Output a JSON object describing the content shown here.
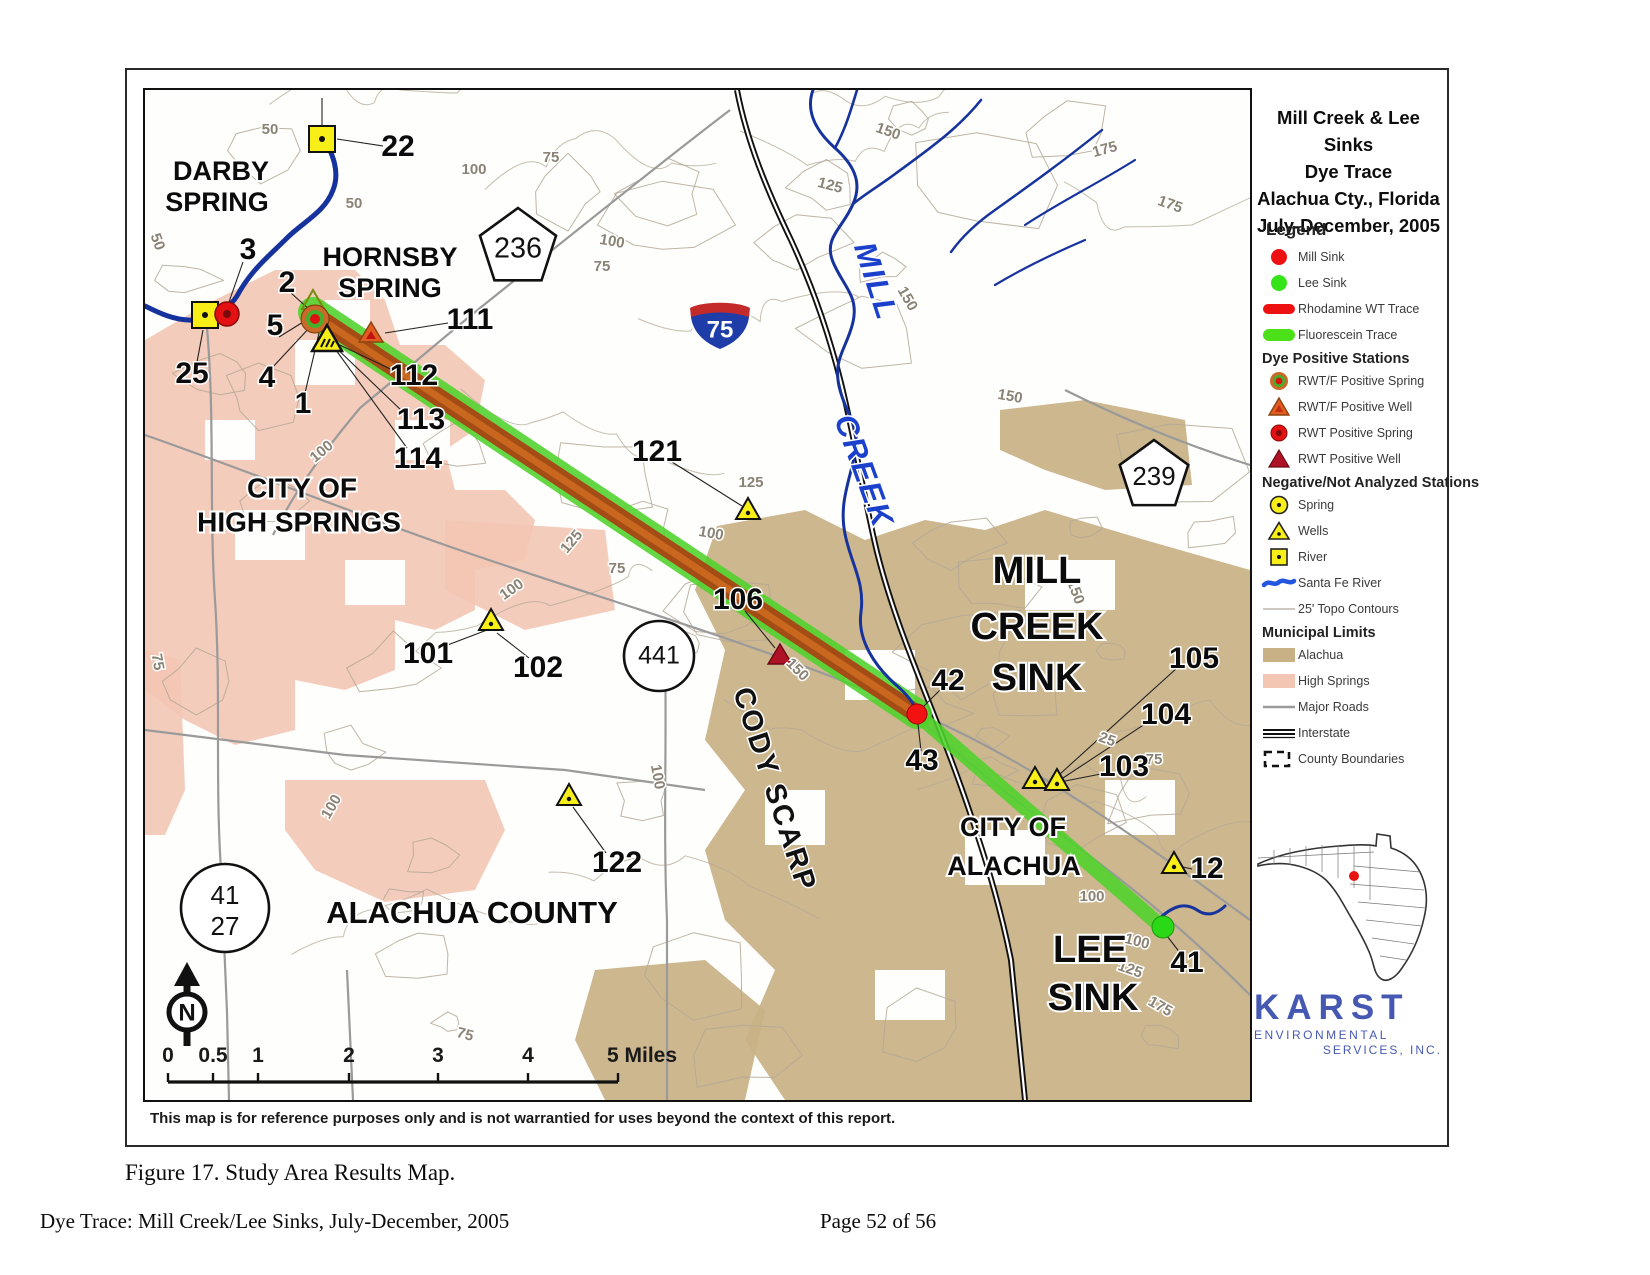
{
  "page": {
    "caption": "Figure 17.  Study Area Results Map.",
    "footer_left": "Dye Trace: Mill Creek/Lee Sinks, July-December, 2005",
    "footer_right": "Page 52 of 56",
    "disclaimer": "This map is for reference purposes only and is not warrantied for uses beyond the context of this report."
  },
  "title_block": {
    "lines": [
      "Mill Creek & Lee Sinks",
      "Dye Trace",
      "Alachua Cty., Florida",
      "July-December, 2005"
    ]
  },
  "legend": {
    "header": "Legend",
    "sections": [
      {
        "header": "",
        "items": [
          {
            "icon": "mill-sink",
            "label": "Mill Sink"
          },
          {
            "icon": "lee-sink",
            "label": "Lee Sink"
          },
          {
            "icon": "rhodamine-trace",
            "label": "Rhodamine WT Trace"
          },
          {
            "icon": "fluorescein-trace",
            "label": "Fluorescein Trace"
          }
        ]
      },
      {
        "header": "Dye Positive Stations",
        "items": [
          {
            "icon": "rwtf-spring",
            "label": "RWT/F Positive Spring"
          },
          {
            "icon": "rwtf-well",
            "label": "RWT/F Positive Well"
          },
          {
            "icon": "rwt-spring",
            "label": "RWT Positive Spring"
          },
          {
            "icon": "rwt-well",
            "label": "RWT Positive Well"
          }
        ]
      },
      {
        "header": "Negative/Not Analyzed Stations",
        "items": [
          {
            "icon": "neg-spring",
            "label": "Spring"
          },
          {
            "icon": "neg-well",
            "label": "Wells"
          },
          {
            "icon": "neg-river",
            "label": "River"
          },
          {
            "icon": "santa-fe",
            "label": "Santa Fe River"
          },
          {
            "icon": "contour",
            "label": "25' Topo Contours"
          }
        ]
      },
      {
        "header": "Municipal Limits",
        "items": [
          {
            "icon": "alachua-swatch",
            "label": "Alachua"
          },
          {
            "icon": "high-springs-swatch",
            "label": "High Springs"
          },
          {
            "icon": "major-road",
            "label": "Major Roads"
          },
          {
            "icon": "interstate",
            "label": "Interstate"
          },
          {
            "icon": "county-boundary",
            "label": "County Boundaries"
          }
        ]
      }
    ]
  },
  "logo": {
    "name": "KARST",
    "line1": "ENVIRONMENTAL",
    "line2": "SERVICES, INC."
  },
  "map": {
    "north_label": "N",
    "scale": {
      "labels": [
        {
          "t": "0",
          "x": 23
        },
        {
          "t": "0.5",
          "x": 68
        },
        {
          "t": "1",
          "x": 113
        },
        {
          "t": "2",
          "x": 204
        },
        {
          "t": "3",
          "x": 293
        },
        {
          "t": "4",
          "x": 383
        },
        {
          "t": "5 Miles",
          "x": 462,
          "start": true
        }
      ],
      "ticks": [
        23,
        68,
        113,
        204,
        293,
        383,
        473
      ],
      "x1": 23,
      "x2": 473,
      "y_bar": 992,
      "y_label": 972
    },
    "station_labels": [
      {
        "t": "22",
        "x": 253,
        "y": 58
      },
      {
        "t": "3",
        "x": 103,
        "y": 161
      },
      {
        "t": "2",
        "x": 142,
        "y": 194
      },
      {
        "t": "5",
        "x": 130,
        "y": 237
      },
      {
        "t": "25",
        "x": 47,
        "y": 285
      },
      {
        "t": "4",
        "x": 122,
        "y": 289
      },
      {
        "t": "1",
        "x": 158,
        "y": 315
      },
      {
        "t": "111",
        "x": 325,
        "y": 231
      },
      {
        "t": "112",
        "x": 269,
        "y": 287
      },
      {
        "t": "113",
        "x": 276,
        "y": 331
      },
      {
        "t": "114",
        "x": 273,
        "y": 370
      },
      {
        "t": "121",
        "x": 512,
        "y": 363
      },
      {
        "t": "101",
        "x": 283,
        "y": 565
      },
      {
        "t": "102",
        "x": 393,
        "y": 579
      },
      {
        "t": "106",
        "x": 593,
        "y": 511
      },
      {
        "t": "42",
        "x": 803,
        "y": 592
      },
      {
        "t": "43",
        "x": 777,
        "y": 672
      },
      {
        "t": "105",
        "x": 1049,
        "y": 570
      },
      {
        "t": "104",
        "x": 1021,
        "y": 626
      },
      {
        "t": "103",
        "x": 979,
        "y": 678
      },
      {
        "t": "122",
        "x": 472,
        "y": 774
      },
      {
        "t": "12",
        "x": 1062,
        "y": 780
      },
      {
        "t": "41",
        "x": 1042,
        "y": 874
      }
    ],
    "place_labels": [
      {
        "t": "DARBY",
        "x": 76,
        "y": 83,
        "s": 27
      },
      {
        "t": "SPRING",
        "x": 72,
        "y": 114,
        "s": 27
      },
      {
        "t": "HORNSBY",
        "x": 245,
        "y": 169,
        "s": 27
      },
      {
        "t": "SPRING",
        "x": 245,
        "y": 200,
        "s": 27
      },
      {
        "t": "CITY OF",
        "x": 157,
        "y": 400,
        "s": 28
      },
      {
        "t": "HIGH SPRINGS",
        "x": 154,
        "y": 434,
        "s": 28
      },
      {
        "t": "ALACHUA COUNTY",
        "x": 327,
        "y": 825,
        "s": 31
      },
      {
        "t": "MILL",
        "x": 892,
        "y": 483,
        "s": 38
      },
      {
        "t": "CREEK",
        "x": 892,
        "y": 539,
        "s": 38
      },
      {
        "t": "SINK",
        "x": 892,
        "y": 590,
        "s": 38
      },
      {
        "t": "CITY OF",
        "x": 868,
        "y": 739,
        "s": 27
      },
      {
        "t": "ALACHUA",
        "x": 869,
        "y": 778,
        "s": 27
      },
      {
        "t": "LEE",
        "x": 945,
        "y": 862,
        "s": 38
      },
      {
        "t": "SINK",
        "x": 948,
        "y": 910,
        "s": 38
      }
    ],
    "rotated_labels": [
      {
        "t": "CODY SCARP",
        "x": 628,
        "y": 700,
        "s": 29,
        "r": 72,
        "c": "#111"
      },
      {
        "t": "MILL",
        "x": 729,
        "y": 192,
        "s": 31,
        "r": 72,
        "c": "#1b41cc",
        "i": true
      },
      {
        "t": "CREEK",
        "x": 717,
        "y": 382,
        "s": 31,
        "r": 70,
        "c": "#1b41cc",
        "i": true
      }
    ],
    "contour_labels": [
      {
        "t": "50",
        "x": 125,
        "y": 40
      },
      {
        "t": "100",
        "x": 329,
        "y": 80
      },
      {
        "t": "75",
        "x": 406,
        "y": 68
      },
      {
        "t": "50",
        "x": 209,
        "y": 114
      },
      {
        "t": "150",
        "x": 743,
        "y": 42,
        "r": 20
      },
      {
        "t": "125",
        "x": 685,
        "y": 96,
        "r": 15
      },
      {
        "t": "175",
        "x": 960,
        "y": 60,
        "r": -15
      },
      {
        "t": "175",
        "x": 1025,
        "y": 115,
        "r": 20
      },
      {
        "t": "100",
        "x": 467,
        "y": 152,
        "r": 10
      },
      {
        "t": "75",
        "x": 457,
        "y": 177
      },
      {
        "t": "150",
        "x": 762,
        "y": 209,
        "r": 60
      },
      {
        "t": "150",
        "x": 865,
        "y": 307,
        "r": 10
      },
      {
        "t": "100",
        "x": 177,
        "y": 362,
        "r": -40
      },
      {
        "t": "125",
        "x": 427,
        "y": 452,
        "r": -50
      },
      {
        "t": "100",
        "x": 367,
        "y": 500,
        "r": -35
      },
      {
        "t": "75",
        "x": 472,
        "y": 479
      },
      {
        "t": "125",
        "x": 606,
        "y": 393
      },
      {
        "t": "100",
        "x": 566,
        "y": 444,
        "r": 10
      },
      {
        "t": "50",
        "x": 12,
        "y": 152,
        "r": 70
      },
      {
        "t": "75",
        "x": 12,
        "y": 572,
        "r": 80
      },
      {
        "t": "100",
        "x": 187,
        "y": 717,
        "r": -60
      },
      {
        "t": "100",
        "x": 512,
        "y": 687,
        "r": 80
      },
      {
        "t": "150",
        "x": 930,
        "y": 502,
        "r": 70
      },
      {
        "t": "25",
        "x": 962,
        "y": 650,
        "r": 20
      },
      {
        "t": "75",
        "x": 1009,
        "y": 670
      },
      {
        "t": "100",
        "x": 947,
        "y": 807
      },
      {
        "t": "100",
        "x": 992,
        "y": 852,
        "r": 15
      },
      {
        "t": "125",
        "x": 985,
        "y": 880,
        "r": 20
      },
      {
        "t": "175",
        "x": 1015,
        "y": 917,
        "r": 30
      },
      {
        "t": "75",
        "x": 320,
        "y": 945,
        "r": 15
      },
      {
        "t": "150",
        "x": 652,
        "y": 580,
        "r": 45
      }
    ],
    "shields": [
      {
        "kind": "pentagon",
        "label": "236",
        "x": 373,
        "y": 154,
        "r": 40
      },
      {
        "kind": "pentagon",
        "label": "239",
        "x": 1009,
        "y": 382,
        "r": 36
      },
      {
        "kind": "interstate",
        "label": "75",
        "x": 575,
        "y": 233
      },
      {
        "kind": "circle1",
        "label": "441",
        "x": 514,
        "y": 566,
        "r": 35
      },
      {
        "kind": "circle2",
        "top": "41",
        "bottom": "27",
        "x": 80,
        "y": 818,
        "r": 44
      }
    ],
    "markers": [
      {
        "type": "river",
        "x": 177,
        "y": 49
      },
      {
        "type": "river",
        "x": 60,
        "y": 225
      },
      {
        "type": "rwt-spring",
        "x": 82,
        "y": 224
      },
      {
        "type": "tri-outline",
        "x": 168,
        "y": 212
      },
      {
        "type": "rwtf-spring",
        "x": 170,
        "y": 229
      },
      {
        "type": "well-hatched",
        "x": 182,
        "y": 251
      },
      {
        "type": "rwtf-well",
        "x": 226,
        "y": 244
      },
      {
        "type": "neg-well",
        "x": 603,
        "y": 421
      },
      {
        "type": "neg-well",
        "x": 346,
        "y": 532
      },
      {
        "type": "rwt-well",
        "x": 635,
        "y": 566
      },
      {
        "type": "mill-sink",
        "x": 772,
        "y": 624
      },
      {
        "type": "neg-well",
        "x": 890,
        "y": 690
      },
      {
        "type": "neg-well",
        "x": 912,
        "y": 692
      },
      {
        "type": "neg-well",
        "x": 424,
        "y": 707
      },
      {
        "type": "neg-well",
        "x": 1029,
        "y": 775
      },
      {
        "type": "lee-sink",
        "x": 1018,
        "y": 837
      }
    ],
    "colors": {
      "salmon": "#f3c6b4",
      "tan": "#c9b186",
      "green_trace": "#4ed32a",
      "red_trace": "#a84414",
      "red_trace_hi": "#cc6a1e",
      "river_blue": "#16339d",
      "creek_label_blue": "#1b41cc",
      "marker_yellow": "#f8ee18",
      "mill_red": "#f21212",
      "lee_green": "#2bd816",
      "interstate_red": "#c32b2b",
      "interstate_blue": "#1f3da8",
      "contour": "#b3a895",
      "road_gray": "#9a9a9a",
      "karst_blue": "#4659b2"
    }
  }
}
